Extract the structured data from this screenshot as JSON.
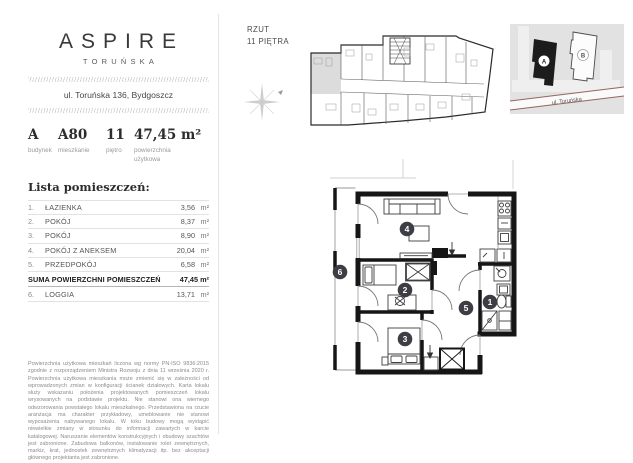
{
  "brand": {
    "name": "ASPIRE",
    "subtitle": "TORUŃSKA",
    "address": "ul. Toruńska 136, Bydgoszcz"
  },
  "unit_info": {
    "building": {
      "value": "A",
      "label": "budynek"
    },
    "apartment": {
      "value": "A80",
      "label": "mieszkanie"
    },
    "floor": {
      "value": "11",
      "label": "piętro"
    },
    "area": {
      "value": "47,45 m²",
      "label": "powierzchnia użytkowa"
    }
  },
  "room_list": {
    "heading": "Lista pomieszczeń:",
    "rows": [
      {
        "no": "1.",
        "name": "ŁAZIENKA",
        "area": "3,56",
        "unit": "m²"
      },
      {
        "no": "2.",
        "name": "POKÓJ",
        "area": "8,37",
        "unit": "m²"
      },
      {
        "no": "3.",
        "name": "POKÓJ",
        "area": "8,90",
        "unit": "m²"
      },
      {
        "no": "4.",
        "name": "POKÓJ Z ANEKSEM",
        "area": "20,04",
        "unit": "m²"
      },
      {
        "no": "5.",
        "name": "PRZEDPOKÓJ",
        "area": "6,58",
        "unit": "m²"
      }
    ],
    "summary": {
      "label": "SUMA POWIERZCHNI POMIESZCZEŃ",
      "area": "47,45 m²"
    },
    "loggia": {
      "no": "6.",
      "name": "LOGGIA",
      "area": "13,71",
      "unit": "m²"
    }
  },
  "floor_plan": {
    "title_line1": "RZUT",
    "title_line2": "11 PIĘTRA",
    "room_badges": [
      "1",
      "2",
      "3",
      "4",
      "5",
      "6"
    ]
  },
  "site_map": {
    "street": "ul. Toruńska",
    "building_a": "A",
    "building_b": "B"
  },
  "disclaimer": "Powierzchnia użytkowa mieszkań liczona wg normy PN-ISO 9836:2015 zgodnie z rozporządzeniem Ministra Rozwoju z dnia 11 września 2020 r. Powierzchnia użytkowa mieszkania może zmienić się w zależności od wprowadzonych zmian w konfiguracji ścianek działowych. Karta lokalu służy wskazaniu położenia projektowanych pomieszczeń lokalu wrysowanych na podstawie projektu. Nie stanowi ona wiernego odwzorowania powstałego lokalu mieszkalnego. Przedstawiona na rzucie aranżacja ma charakter przykładowy, umeblowanie nie stanowi wyposażenia nabywanego lokalu. W toku budowy mogą wystąpić niewielkie zmiany w stosunku do informacji zawartych w karcie katalogowej. Naruszanie elementów konstrukcyjnych i obudowy szachtów jest zabronione. Zabudowa balkonów, instalowanie rolet zewnętrznych, markiz, krat, jednostek zewnętrznych klimatyzacji itp. bez akceptacji głównego projektanta jest zabronione.",
  "colors": {
    "wall": "#161616",
    "badge": "#3d3d45",
    "street_line": "#96655b",
    "highlight_unit": "#dcdcdc"
  }
}
